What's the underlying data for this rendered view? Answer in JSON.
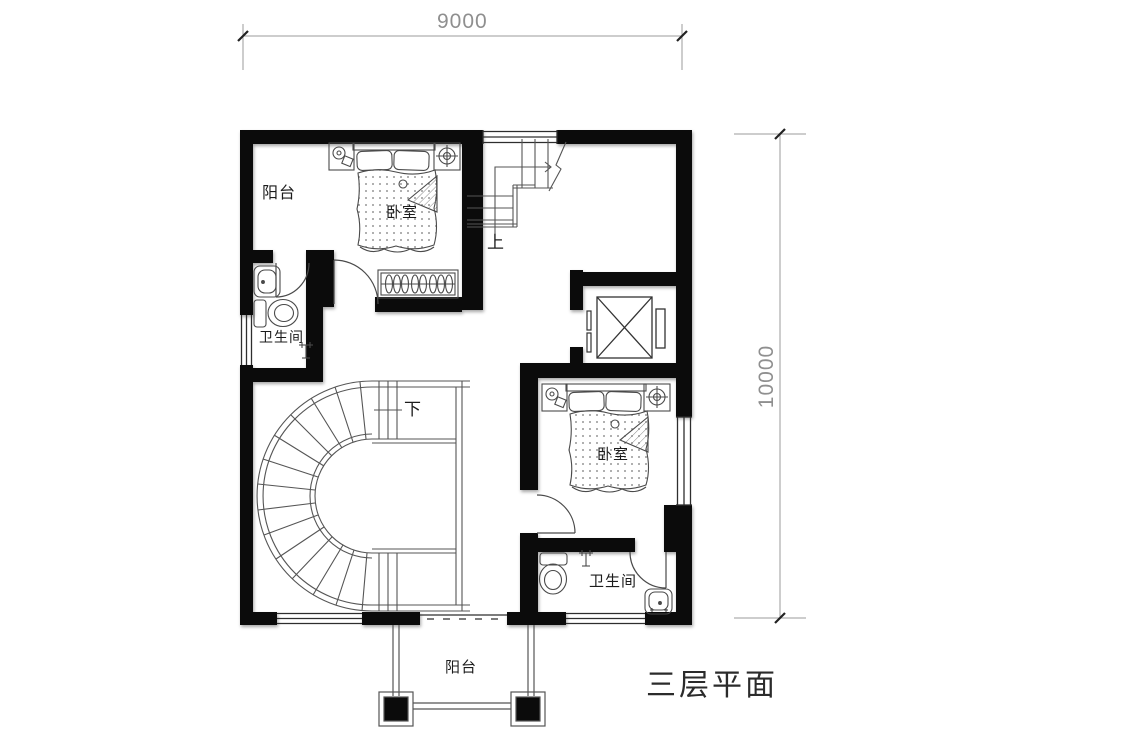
{
  "title": "三层平面",
  "dimensions": {
    "top": "9000",
    "right": "10000"
  },
  "rooms": {
    "balcony_top": "阳台",
    "bedroom1": "卧室",
    "bathroom1": "卫生间",
    "bedroom2": "卧室",
    "bathroom2": "卫生间",
    "balcony_bottom": "阳台"
  },
  "stairs": {
    "up": "上",
    "down": "下"
  },
  "colors": {
    "background": "#ffffff",
    "wall": "#0b0b0b",
    "furniture_line": "#4a4a4a",
    "window_line": "#2e2e2e",
    "dimension": "#8f8f8f",
    "label_text": "#1c1c1c"
  },
  "icons": [
    "double-bed-icon",
    "pillow-icon",
    "bedside-lamp-icon",
    "ceiling-light-icon",
    "wardrobe-icon",
    "toilet-icon",
    "sink-icon",
    "shower-head-icon",
    "elevator-shaft-icon",
    "spiral-staircase-icon",
    "straight-staircase-icon",
    "door-swing-icon",
    "window-icon",
    "balcony-railing-icon",
    "column-icon",
    "dimension-tick-icon"
  ]
}
